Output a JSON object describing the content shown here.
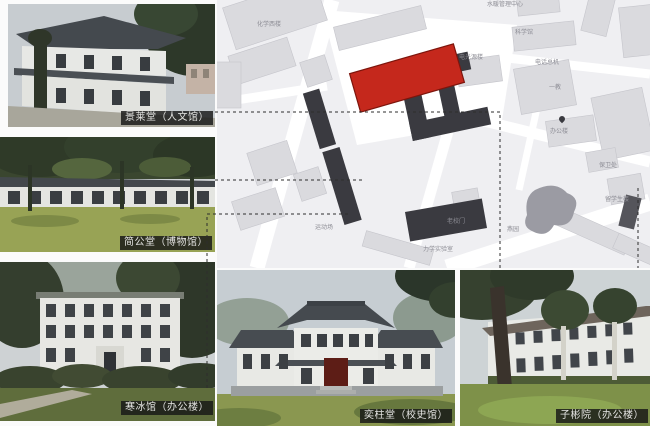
{
  "photos": [
    {
      "caption": "景莱堂（人文馆）"
    },
    {
      "caption": "简公堂（博物馆）"
    },
    {
      "caption": "寒冰馆（办公楼）"
    },
    {
      "caption": "奕柱堂（校史馆）"
    },
    {
      "caption": "子彬院（办公楼）"
    }
  ],
  "map": {
    "colors": {
      "highlight": "#c5281c",
      "dark_building": "#3a3a40",
      "building": "#dadade",
      "background": "#efeff2",
      "road": "#ffffff",
      "pond": "#9b9ba3"
    },
    "labels": {
      "chemistry_west": "化学西楼",
      "utility_center": "水暖管理中心",
      "science_hall": "科学馆",
      "light_source_lab": "电光源楼",
      "telephone_exchange": "电话总机",
      "teaching_bldg_1": "一教",
      "office_bldg": "办公楼",
      "security_office": "保卫处",
      "intl_student_bldg": "留学生楼",
      "old_school_gate": "老校门",
      "mechanics_lab": "力学实验室",
      "yan_garden": "燕园",
      "sports_field": "运动场"
    }
  }
}
